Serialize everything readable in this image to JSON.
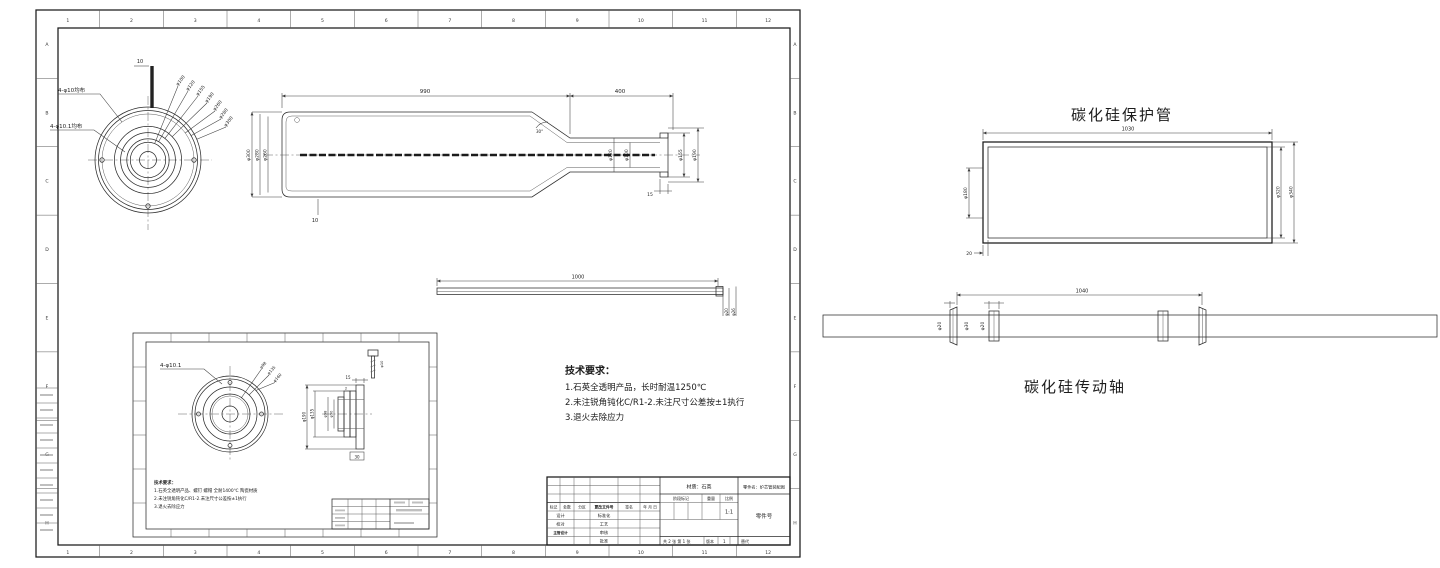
{
  "left_sheet": {
    "grid_cols": [
      "1",
      "2",
      "3",
      "4",
      "5",
      "6",
      "7",
      "8",
      "9",
      "10",
      "11",
      "12"
    ],
    "grid_rows": [
      "A",
      "B",
      "C",
      "D",
      "E",
      "F",
      "G",
      "H"
    ],
    "end_view": {
      "holes_outer": "4-φ10均布",
      "holes_inner": "4-φ10.1均布",
      "dim_top": "10",
      "radial_dims": [
        "φ100",
        "φ120",
        "φ155",
        "φ190",
        "φ260",
        "φ280",
        "φ300"
      ]
    },
    "side_view": {
      "len_main": "990",
      "len_neck": "400",
      "dia_left_1": "φ300",
      "dia_left_2": "φ280",
      "dia_left_3": "φ260",
      "dia_neck_1": "φ120",
      "dia_neck_2": "φ100",
      "dia_end_1": "φ155",
      "dia_end_2": "φ190",
      "dim_flange": "15",
      "dim_wall": "10",
      "angle": "30°"
    },
    "rod_view": {
      "length": "1000",
      "dia_1": "φ20",
      "dia_2": "φ26"
    },
    "tech_req": {
      "title": "技术要求：",
      "line1": "1.石英全透明产品，长时耐温1250℃",
      "line2": "2.未注锐角钝化C/R1-2.未注尺寸公差按±1执行",
      "line3": "3.退火去除应力"
    },
    "inset": {
      "holes": "4-φ10.1",
      "radial_dims": [
        "φ98",
        "φ135",
        "φ160"
      ],
      "dia_1": "φ190",
      "dia_2": "φ135",
      "dia_3": "φ98",
      "dia_4": "φ90",
      "dim_1": "15",
      "dim_2": "2",
      "dim_3": "30",
      "bolt_dia": "φ10",
      "tech_title": "技术要求：",
      "tech_line1": "1.石英全透明产品、螺钉 螺帽 全耐1400℃ 陶瓷材质",
      "tech_line2": "2.未注锐角钝化C/R1-2.未注尺寸公差按±1执行",
      "tech_line3": "3.退火去除应力"
    },
    "title_block": {
      "material": "材质：石英",
      "part_name": "零件名：炉芯管装配图",
      "part_no": "零件号",
      "stage": "阶段标记",
      "weight": "重量",
      "scale": "比例",
      "scale_value": "1:1",
      "mark": "标记",
      "qty": "处数",
      "zone": "分区",
      "file_no": "更改文件号",
      "sign": "签名",
      "date": "年 月 日",
      "design": "设计",
      "check": "校对",
      "chief": "主管设计",
      "std": "标准化",
      "process": "工艺",
      "audit": "审核",
      "approve": "批准",
      "sheets": "共 2 张 第 1 张",
      "version": "版本",
      "version_value": "1",
      "replace": "替代"
    }
  },
  "right_panel": {
    "protect_tube": {
      "title": "碳化硅保护管",
      "length": "1030",
      "dia_left": "φ180",
      "dia_inner": "φ320",
      "dia_outer": "φ340",
      "dim_wall": "20"
    },
    "drive_shaft": {
      "title": "碳化硅传动轴",
      "length": "1040",
      "dia_1": "φ20",
      "dia_2": "φ30",
      "dia_3": "φ20"
    }
  }
}
